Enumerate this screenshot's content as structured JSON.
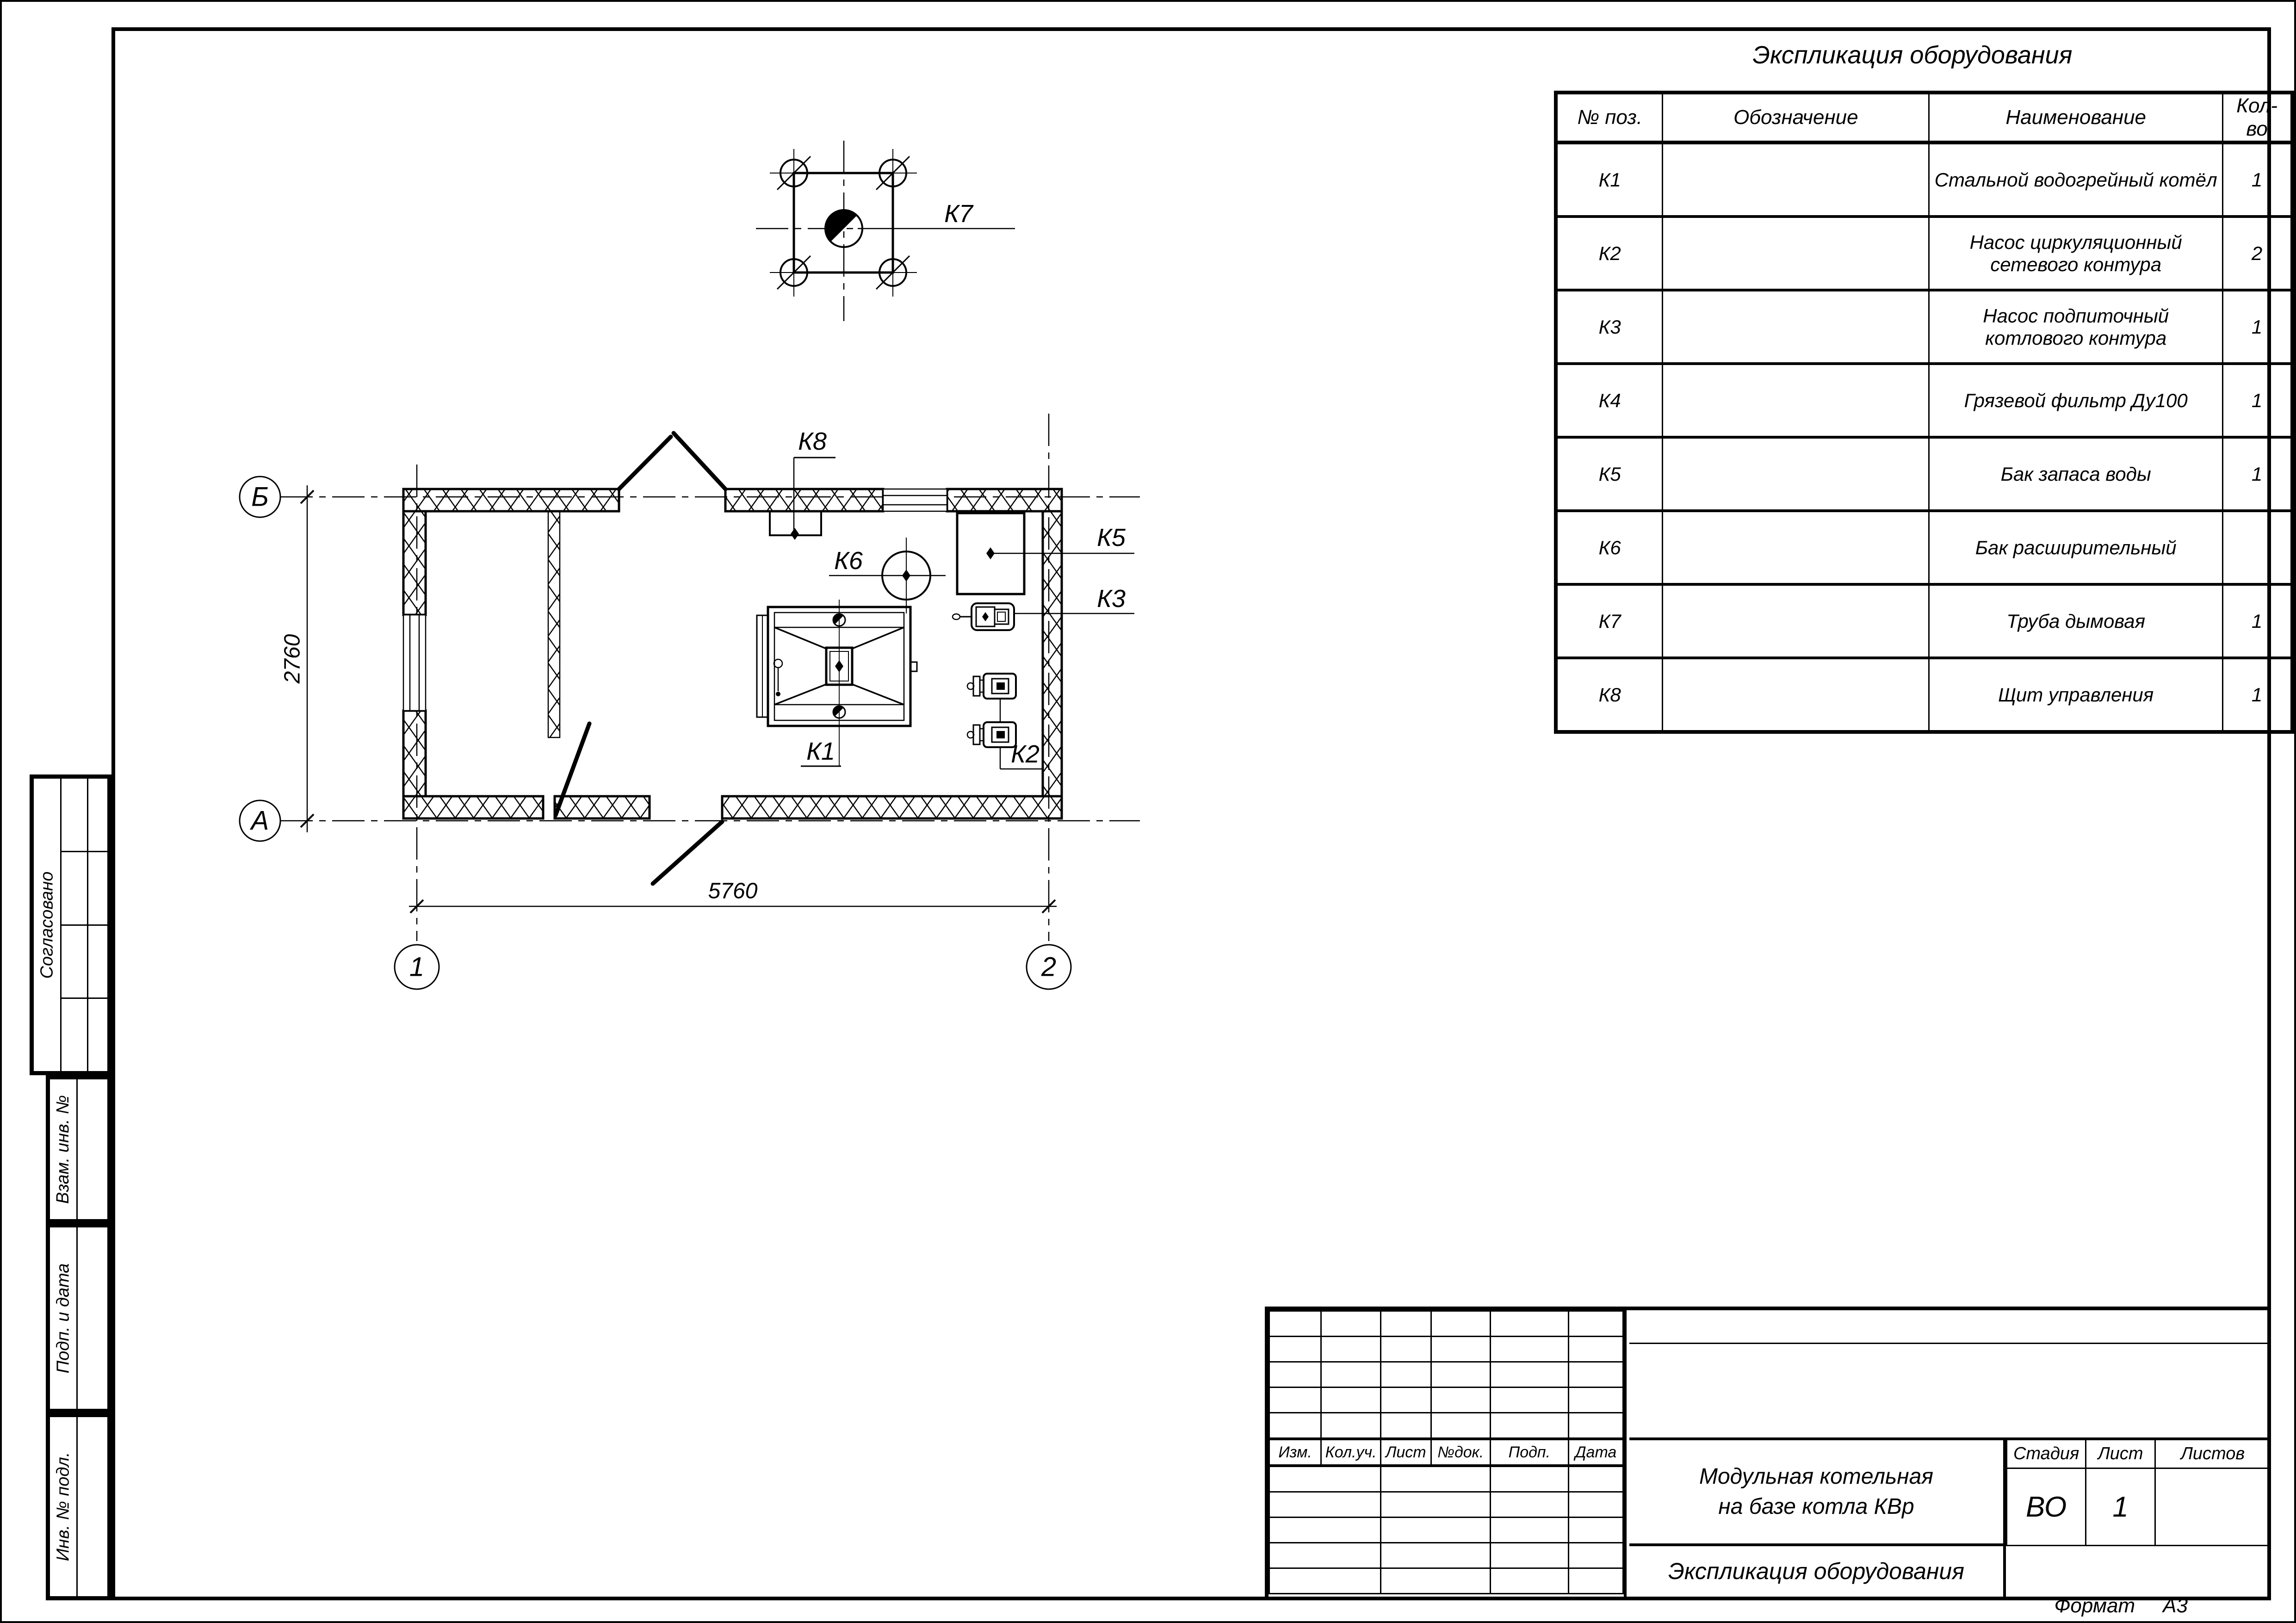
{
  "equipment_table": {
    "title": "Экспликация оборудования",
    "columns": [
      "№ поз.",
      "Обозначение",
      "Наименование",
      "Кол-во"
    ],
    "rows": [
      {
        "pos": "К1",
        "designation": "",
        "name": "Стальной водогрейный котёл",
        "qty": "1"
      },
      {
        "pos": "К2",
        "designation": "",
        "name": "Насос циркуляционный сетевого контура",
        "qty": "2"
      },
      {
        "pos": "К3",
        "designation": "",
        "name": "Насос подпиточный котлового контура",
        "qty": "1"
      },
      {
        "pos": "К4",
        "designation": "",
        "name": "Грязевой фильтр Ду100",
        "qty": "1"
      },
      {
        "pos": "К5",
        "designation": "",
        "name": "Бак запаса воды",
        "qty": "1"
      },
      {
        "pos": "К6",
        "designation": "",
        "name": "Бак расширительный",
        "qty": ""
      },
      {
        "pos": "К7",
        "designation": "",
        "name": "Труба дымовая",
        "qty": "1"
      },
      {
        "pos": "К8",
        "designation": "",
        "name": "Щит управления",
        "qty": "1"
      }
    ]
  },
  "title_block": {
    "revision_columns": [
      "Изм.",
      "Кол.уч.",
      "Лист",
      "№док.",
      "Подп.",
      "Дата"
    ],
    "project_title_line1": "Модульная котельная",
    "project_title_line2": "на базе котла КВр",
    "sheet_title": "Экспликация оборудования",
    "stage_label": "Стадия",
    "sheet_label": "Лист",
    "sheets_label": "Листов",
    "stage_value": "ВО",
    "sheet_value": "1",
    "sheets_value": ""
  },
  "side_stamp": {
    "agreed": "Согласовано",
    "items": [
      "Взам. инв. №",
      "Подп. и дата",
      "Инв. № подл."
    ]
  },
  "footer": {
    "format_label": "Формат",
    "format_value": "А3"
  },
  "plan": {
    "labels": {
      "k1": "К1",
      "k2": "К2",
      "k3": "К3",
      "k5": "К5",
      "k6": "К6",
      "k7": "К7",
      "k8": "К8",
      "axis_b": "Б",
      "axis_a": "А",
      "axis_1": "1",
      "axis_2": "2"
    },
    "dimensions": {
      "width": "5760",
      "height": "2760"
    }
  }
}
